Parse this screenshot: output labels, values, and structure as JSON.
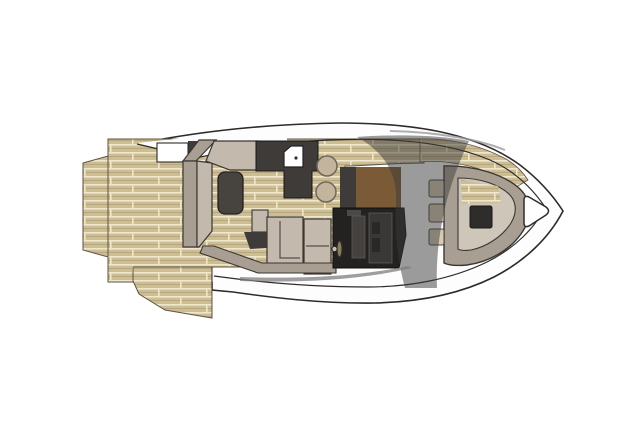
{
  "page": {
    "title": "yacht-deck-floor-plan",
    "canvas": {
      "width": 637,
      "height": 425
    }
  },
  "colors": {
    "background": "#ffffff",
    "outline": "#2e2c29",
    "hull": "#fdfdfd",
    "teak_base": "#cdbd94",
    "teak_stripe": "#efe7cb",
    "teak_grain": "#b3a277",
    "teak_edge": "#5d5342",
    "furniture_back": "#a89e92",
    "furniture_seat": "#c3b9ac",
    "furniture_stroke": "#3a3733",
    "charcoal": "#3e3b38",
    "console": "#232220",
    "console_panel": "#44413e",
    "console_inner": "#2a2827",
    "helm_brown": "#7b5b37",
    "seat_white": "#ffffff",
    "stool": "#c2b59b",
    "stool_stroke": "#6e675c",
    "hatch": "#2e2d2b",
    "pad": "#d7ccb2",
    "tint": "#3a3a3a",
    "sliver": "#7d7d7d",
    "hardtop_line": "#9a9a9a",
    "table": "#47443f",
    "wheel": "#8d7c5a",
    "locker": "#ffffff"
  },
  "regions": {
    "hull": "Hull",
    "gunwale": "Gunwale line",
    "swim_platform": "Swim platform",
    "swim_step": "Swim step",
    "cockpit_deck": "Cockpit teak deck",
    "cockpit_sofa": "Cockpit sofa",
    "cockpit_table": "Cockpit table",
    "aft_bench": "Aft bench",
    "wet_bar": "Wet bar",
    "sink": "Sink",
    "bar_stools": "Bar stools",
    "helm": "Helm station",
    "steering_wheel": "Steering wheel",
    "windshield": "Windshield",
    "bow_lounge": "Bow lounge",
    "bow_hatch": "Bow hatch",
    "step_pads": "Side pads",
    "anchor_locker": "Anchor locker"
  }
}
